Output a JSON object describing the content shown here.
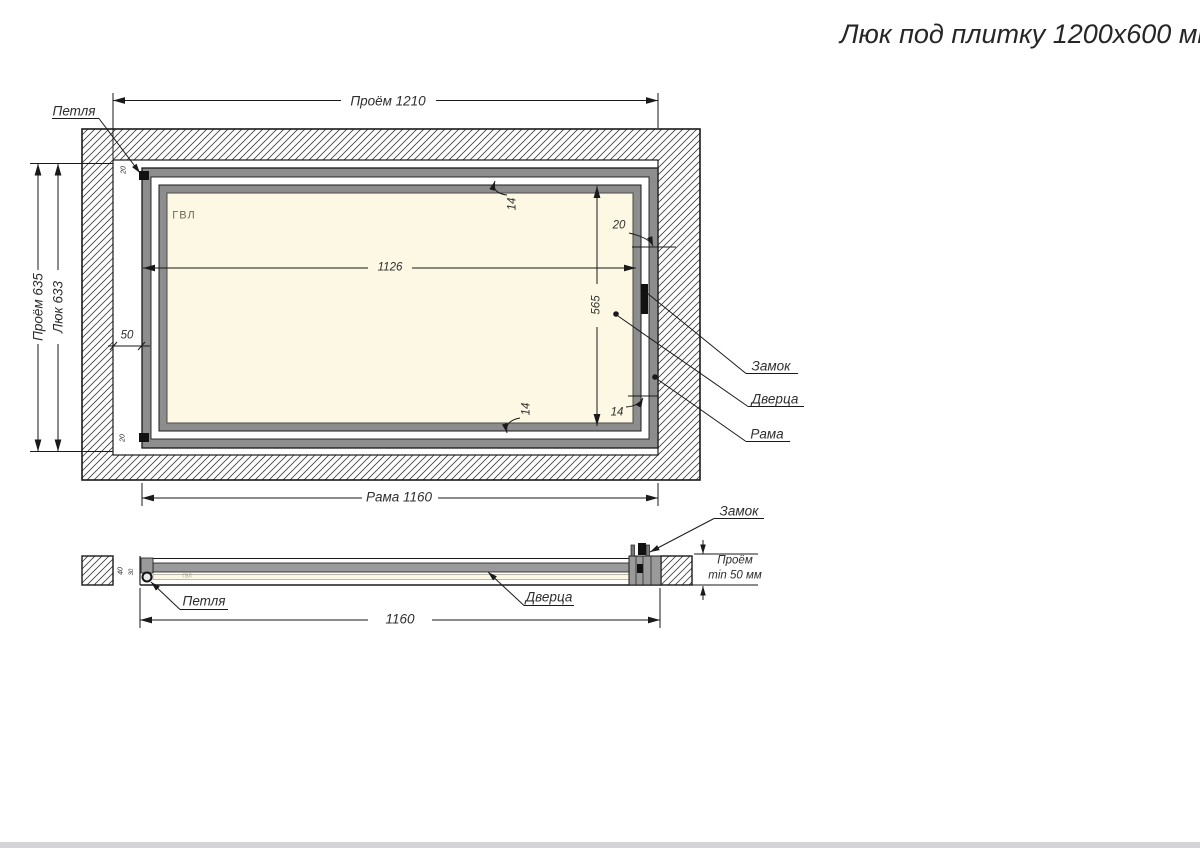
{
  "title": "Люк под плитку 1200х600 мм",
  "front": {
    "material": "ГВЛ",
    "callout_hinge": "Петля",
    "callout_lock": "Замок",
    "callout_door": "Дверца",
    "callout_frame": "Рама",
    "dim_opening_w": "Проём 1210",
    "dim_opening_h": "Проём 635",
    "dim_hatch_h": "Люк 633",
    "dim_inner_w": "1126",
    "dim_inner_h": "565",
    "dim_gap_left": "50",
    "dim_gap_right": "20",
    "dim_gap_top": "14",
    "dim_gap_bottom": "14",
    "dim_gap_bottom_right": "14",
    "dim_hinge_offset_top": "20",
    "dim_hinge_offset_bottom": "20",
    "dim_frame_w": "Рама 1160"
  },
  "section": {
    "material": "ГВЛ",
    "callout_lock": "Замок",
    "callout_hinge": "Петля",
    "callout_door": "Дверца",
    "dim_frame_depth": "40",
    "dim_door_depth": "30",
    "dim_frame_w": "1160",
    "dim_niche_word": "Проём",
    "dim_niche_min": "min 50 мм"
  },
  "colors": {
    "frame_gray": "#8d8d8d",
    "panel_cream": "#fcf8e3",
    "line": "#1a1a1a",
    "footer_bar": "#d3d3d8"
  }
}
